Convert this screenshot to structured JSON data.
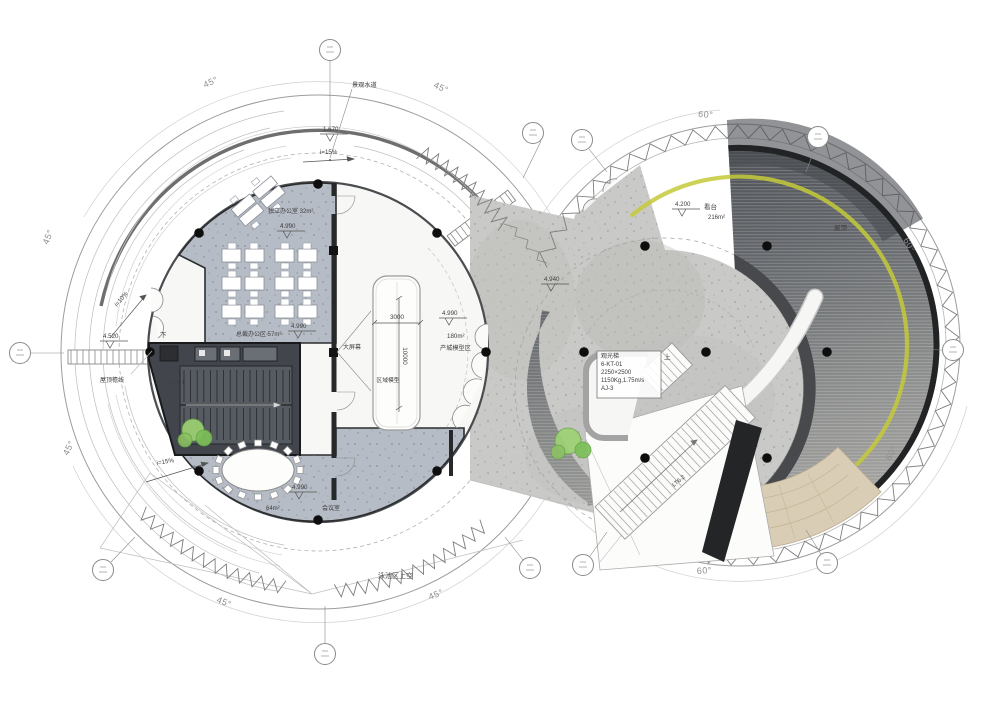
{
  "plan": {
    "angles": {
      "a45": "45°",
      "a60": "60°"
    },
    "slopes": {
      "s15": "i=15%",
      "s10": "i=10%"
    },
    "levels": {
      "lv1670": "1.670",
      "lv4990": "4.990",
      "lv4940": "4.940",
      "lv4520": "4.520",
      "lv4200": "4.200"
    },
    "dims": {
      "w": "3000",
      "h": "10000"
    },
    "rooms": {
      "office_private": "独立办公室 32m²",
      "office_exec": "总裁办公区 57m²",
      "meeting_size": "64m²",
      "meeting": "会议室",
      "model_area_size": "180m²",
      "model_area": "产城模型区",
      "model": "区域模型",
      "screen": "大屏幕",
      "stand": "看台",
      "stand_size": "216m²",
      "roof": "屋顶",
      "pool": "泳池区上空",
      "waterway": "景观水道",
      "eave": "屋顶檐线"
    },
    "stairs": {
      "lt61": "LT6-1",
      "lt62": "LT6-2",
      "up": "上",
      "down": "下"
    },
    "elevator": {
      "l1": "观光梯",
      "l2": "6-KT-01",
      "l3": "2250×2500",
      "l4": "1150Kg,1.75m/s",
      "l5": "AJ-3"
    },
    "colors": {
      "accent_yellow": "#c4ca39",
      "deck_dark": "#54575b",
      "amphitheater_tan": "#d9cdb6",
      "tree_green": "#8cc163",
      "room_gray": "#b6bcc5",
      "concrete": "#c9c9c7",
      "ink": "#26282a"
    }
  }
}
